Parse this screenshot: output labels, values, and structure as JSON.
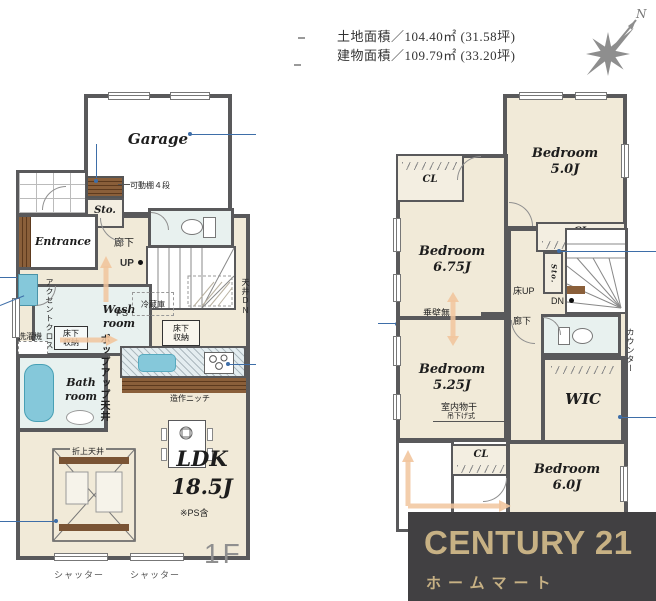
{
  "header": {
    "land_area": "土地面積／104.40㎡ (31.58坪)",
    "building_area": "建物面積／109.79㎡ (33.20坪)"
  },
  "compass": {
    "north": "N"
  },
  "floor1": {
    "floor_label": "1F",
    "garage": "Garage",
    "storage": "Sto.",
    "shelf_note": "可動棚４段",
    "entrance": "Entrance",
    "hallway": "廊下",
    "up": "UP",
    "ceiling_down": "天井DN",
    "washroom": "Wash room",
    "accent_cloth": "アクセントクロス",
    "washer": "洗濯機",
    "underfloor_wash": "床下収納",
    "bathroom": "Bath room",
    "ps": "PS",
    "fridge": "冷蔵庫",
    "underfloor_kitchen": "床下収納",
    "popup_ceiling": "ポップアップ天井",
    "niche": "造作ニッチ",
    "coffered": "折上天井",
    "ldk": {
      "name": "LDK",
      "size": "18.5J",
      "note": "※PS含"
    },
    "shutter_left": "シャッター",
    "shutter_right": "シャッター"
  },
  "floor2": {
    "bedroom5": {
      "name": "Bedroom",
      "size": "5.0J"
    },
    "bedroom675": {
      "name": "Bedroom",
      "size": "6.75J"
    },
    "bedroom525": {
      "name": "Bedroom",
      "size": "5.25J"
    },
    "bedroom6": {
      "name": "Bedroom",
      "size": "6.0J"
    },
    "cl_top": "CL",
    "cl_mid": "CL",
    "cl_bottom": "CL",
    "storage": "Sto.",
    "floor_up": "床UP",
    "down": "DN",
    "hallway": "廊下",
    "counter": "カウンター",
    "hanging_wall": "垂壁無",
    "wall_line": "（壁想定ライン）",
    "indoor_drying": "室内物干",
    "hanging_type": "吊下げ式",
    "wic": "WIC"
  },
  "logo": {
    "brand": "CENTURY 21",
    "company": "ホームマート"
  },
  "colors": {
    "wall": "#59595b",
    "floor": "#f1ead8",
    "wet": "#e8f1ef",
    "closet": "#f3eee1",
    "fixture": "#85c8da",
    "wood": "#835a38",
    "arrow": "#f2c69e",
    "leader": "#3e6ea8",
    "logo-bg": "#414042",
    "logo-gold": "#c7b184",
    "compass": "#8e8e8e"
  }
}
